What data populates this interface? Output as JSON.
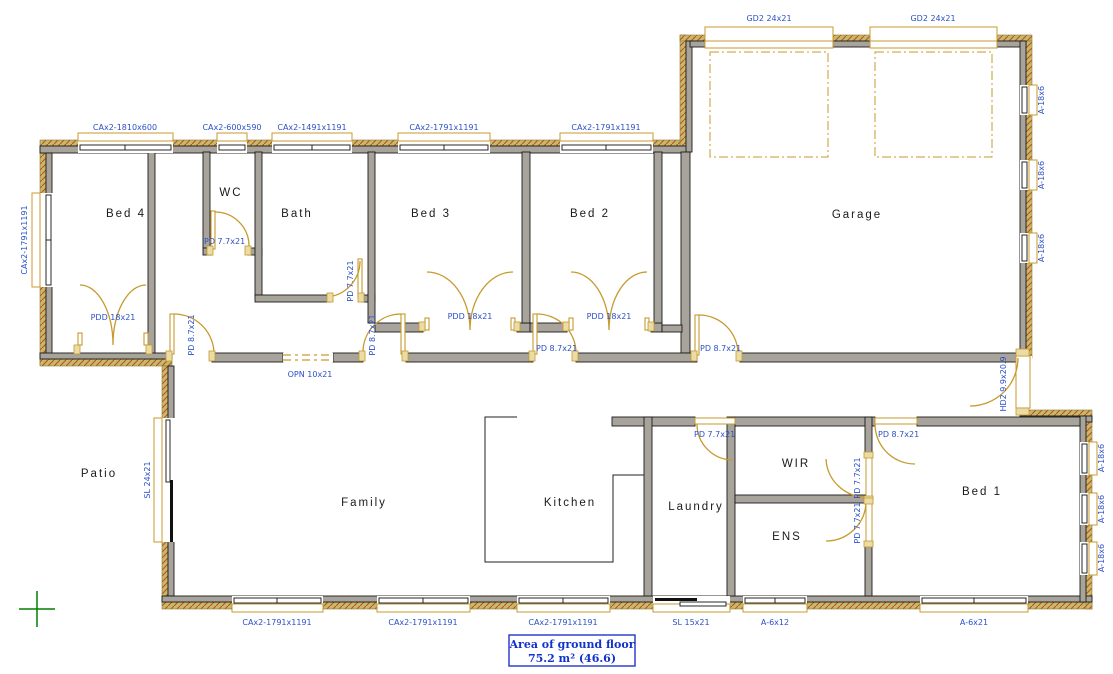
{
  "rooms": {
    "bed4": "Bed 4",
    "wc": "WC",
    "bath": "Bath",
    "bed3": "Bed 3",
    "bed2": "Bed 2",
    "garage": "Garage",
    "patio": "Patio",
    "family": "Family",
    "kitchen": "Kitchen",
    "laundry": "Laundry",
    "wir": "WIR",
    "ens": "ENS",
    "bed1": "Bed 1"
  },
  "windows": {
    "top1": "CAx2-1810x600",
    "top2": "CAx2-600x590",
    "top3": "CAx2-1491x1191",
    "top4": "CAx2-1791x1191",
    "top5": "CAx2-1791x1191",
    "left_bed4": "CAx2-1791x1191",
    "garage_door1": "GD2 24x21",
    "garage_door2": "GD2 24x21",
    "garage_right1": "A-18x6",
    "garage_right2": "A-18x6",
    "garage_right3": "A-18x6",
    "bed1_right1": "A-18x6",
    "bed1_right2": "A-18x6",
    "bed1_right3": "A-18x6",
    "bottom1": "CAx2-1791x1191",
    "bottom2": "CAx2-1791x1191",
    "bottom3": "CAx2-1791x1191",
    "laundry_slider": "SL 15x21",
    "ens_bottom": "A-6x12",
    "bed1_bottom": "A-6x21",
    "family_slider": "SL 24x21"
  },
  "doors": {
    "wc": "PD 7.7x21",
    "bath": "PD 7.7x21",
    "hall_left": "PD 8.7x21",
    "hall_opening": "OPN 10x21",
    "hall_mid": "PD 8.7x21",
    "hall_bed3": "PD 8.7x21",
    "garage_entry": "PD 8.7x21",
    "laundry": "PD 7.7x21",
    "bed1": "PD 8.7x21",
    "wir": "PD 7.7x21",
    "ens": "PD 7.7x21",
    "front_entry": "HD2 9.9x20.9",
    "bed4_robe": "PDD 18x21",
    "bed3_robe": "PDD 18x21",
    "bed2_robe": "PDD 18x21"
  },
  "area_box": {
    "title": "Area of ground floor",
    "value": "75.2 m²  (46.6)"
  },
  "colors": {
    "label_blue": "#2B50C8",
    "door_gold": "#C79A2E",
    "wall_gray": "#A8A49B",
    "brick_tan": "#C9B76B",
    "brick_hatch": "#B5551F",
    "origin_green": "#008000",
    "area_border_blue": "#2233CC"
  }
}
